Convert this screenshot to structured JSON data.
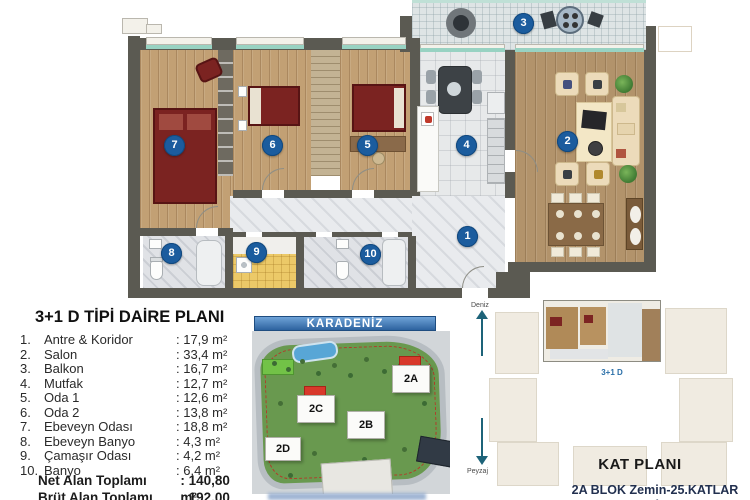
{
  "legend": {
    "title": "3+1 D TİPİ DAİRE PLANI",
    "items": [
      {
        "num": "1.",
        "name": "Antre & Koridor",
        "area": ": 17,9 m²"
      },
      {
        "num": "2.",
        "name": "Salon",
        "area": ": 33,4 m²"
      },
      {
        "num": "3.",
        "name": "Balkon",
        "area": ": 16,7 m²"
      },
      {
        "num": "4.",
        "name": "Mutfak",
        "area": ": 12,7 m²"
      },
      {
        "num": "5.",
        "name": "Oda 1",
        "area": ": 12,6 m²"
      },
      {
        "num": "6.",
        "name": "Oda 2",
        "area": ": 13,8 m²"
      },
      {
        "num": "7.",
        "name": "Ebeveyn Odası",
        "area": ": 18,8 m²"
      },
      {
        "num": "8.",
        "name": "Ebeveyn Banyo",
        "area": ": 4,3 m²"
      },
      {
        "num": "9.",
        "name": "Çamaşır Odası",
        "area": ": 4,2 m²"
      },
      {
        "num": "10.",
        "name": "Banyo",
        "area": ": 6,4 m²"
      }
    ],
    "totals": [
      {
        "label": "Net Alan Toplamı",
        "value": ": 140,80 m²"
      },
      {
        "label": "Brüt Alan Toplamı",
        "value": ": 192,00 m²"
      }
    ]
  },
  "floorplan": {
    "markers": [
      "1",
      "2",
      "3",
      "4",
      "5",
      "6",
      "7",
      "8",
      "9",
      "10"
    ]
  },
  "site_plan": {
    "header": "KARADENİZ",
    "blocks": {
      "a": "2A",
      "b": "2B",
      "c": "2C",
      "d": "2D"
    }
  },
  "kat_plani": {
    "title": "KAT PLANI",
    "unit_label": "3+1 D",
    "direction_top": "Deniz",
    "direction_bottom": "Peyzaj",
    "line1": "2A BLOK Zemin-25.KATLAR",
    "line2": "2C BLOK Zemin-15.KATLAR"
  },
  "colors": {
    "marker_blue": "#1b5c9e",
    "wall_gray": "#5b5a52",
    "wood_floor": "#c2a074",
    "balcony_tile": "#dee4e5",
    "window_teal": "#98d2c2",
    "site_header_blue": "#3e7dbd",
    "highlight_red": "#d8392b",
    "kat_plani_text": "#1e2b4f"
  }
}
